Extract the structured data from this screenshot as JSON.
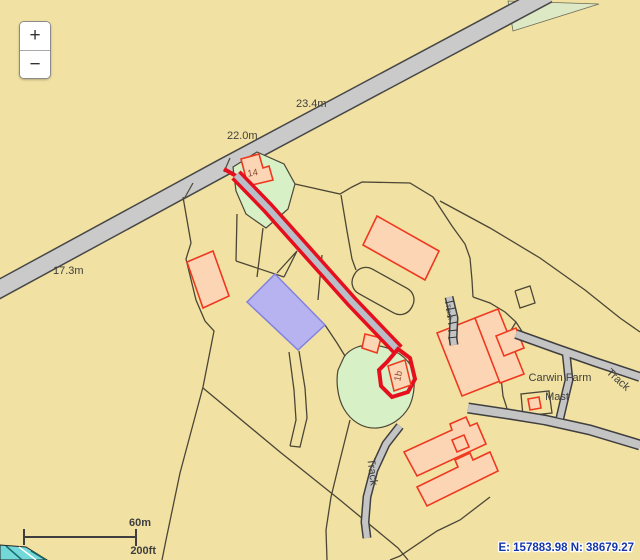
{
  "controls": {
    "zoom_in_label": "+",
    "zoom_out_label": "−"
  },
  "scale_bar": {
    "metric_label": "60m",
    "imperial_label": "200ft"
  },
  "status_bar": {
    "coordinates": "E: 157883.98 N: 38679.27"
  },
  "map": {
    "labels": {
      "contour_a": "23.4m",
      "contour_b": "22.0m",
      "contour_c": "17.3m",
      "building_14": "14",
      "building_1b": "1b",
      "farm_name": "Carwin Farm",
      "mast": "Mast",
      "track_ne": "Track",
      "track_south": "Track",
      "track_steps": "Track"
    },
    "colors": {
      "background": "#f1e1a2",
      "road_fill": "#cacaca",
      "track_fill": "#c4c4c4",
      "route_red": "#e60f1d",
      "building_fill": "#fcd6b4",
      "building_outline": "#ee3920",
      "green_fill": "#d7f0c6",
      "blue_fill": "#b7b3f1",
      "water_fill": "#72d8d8",
      "boundary": "#4c4636",
      "label_text": "#3f3f3f",
      "coordinate_text": "#1536a8"
    }
  }
}
